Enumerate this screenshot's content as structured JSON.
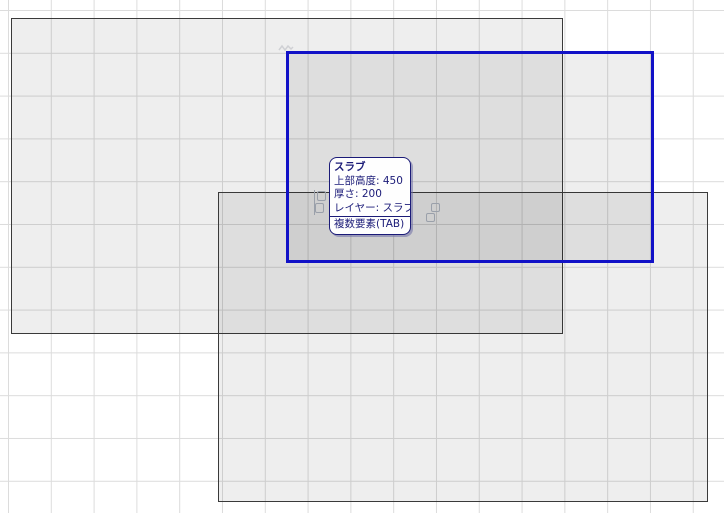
{
  "tooltip": {
    "title": "スラブ",
    "lines": [
      "上部高度: 450",
      "厚さ: 200",
      "レイヤー: スラブ"
    ],
    "footer": "複数要素(TAB)"
  },
  "slabs": [
    {
      "name": "slab-1",
      "state": "normal"
    },
    {
      "name": "slab-2",
      "state": "normal"
    },
    {
      "name": "slab-3",
      "state": "highlighted"
    }
  ],
  "colors": {
    "canvas_background": "#ffffff",
    "grid_line": "#dcdcdc",
    "slab_fill": "rgba(0,0,0,0.065)",
    "slab_border": "#3a3a3a",
    "highlight_blue": "#1111c7",
    "tooltip_ink": "#1b1b78",
    "tooltip_background": "#fefefe",
    "cursor_glyph_gray": "#9aa0aa"
  },
  "icons": {
    "multi_element_cursor": "stacked-squares",
    "snap_mark": "zigzag-scribble"
  }
}
